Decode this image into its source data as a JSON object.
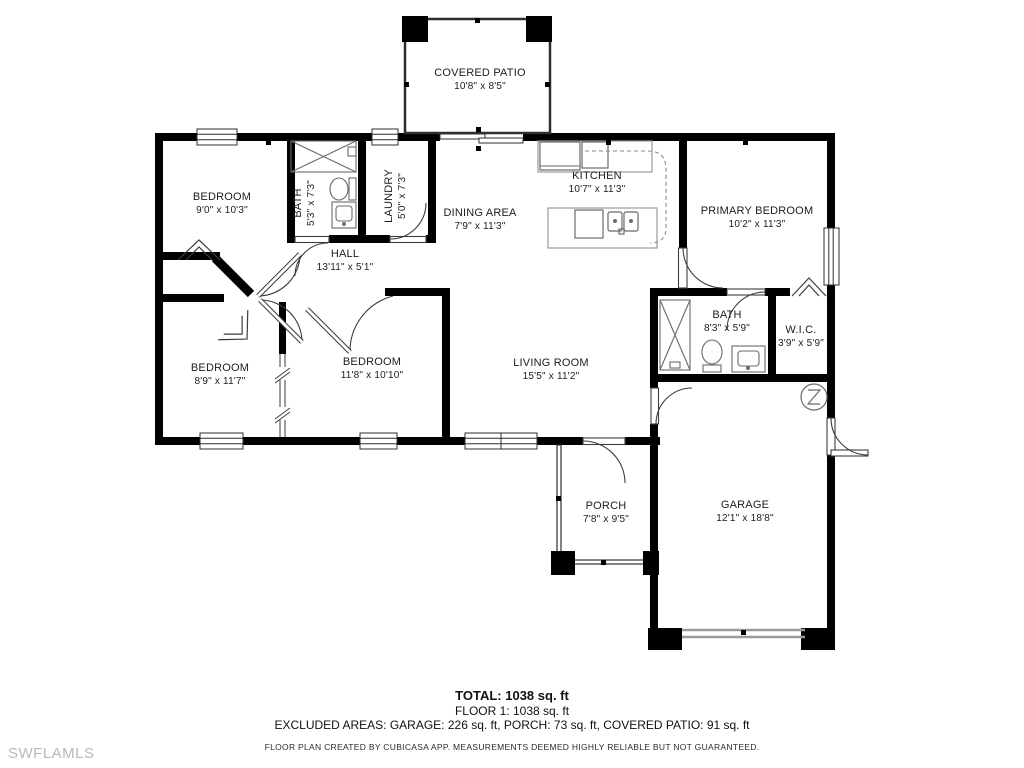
{
  "watermark": "SWFLAMLS",
  "rooms": {
    "covered_patio": {
      "name": "COVERED PATIO",
      "dims": "10'8\" x 8'5\""
    },
    "bedroom1": {
      "name": "BEDROOM",
      "dims": "9'0\" x 10'3\""
    },
    "bath1": {
      "name": "BATH",
      "dims": "5'3\" x 7'3\""
    },
    "laundry": {
      "name": "LAUNDRY",
      "dims": "5'0\" x 7'3\""
    },
    "dining": {
      "name": "DINING AREA",
      "dims": "7'9\" x 11'3\""
    },
    "kitchen": {
      "name": "KITCHEN",
      "dims": "10'7\" x 11'3\""
    },
    "primary": {
      "name": "PRIMARY BEDROOM",
      "dims": "10'2\" x 11'3\""
    },
    "hall": {
      "name": "HALL",
      "dims": "13'11\" x 5'1\""
    },
    "bath2": {
      "name": "BATH",
      "dims": "8'3\" x 5'9\""
    },
    "wic": {
      "name": "W.I.C.",
      "dims": "3'9\" x 5'9\""
    },
    "bedroom2": {
      "name": "BEDROOM",
      "dims": "8'9\" x 11'7\""
    },
    "bedroom3": {
      "name": "BEDROOM",
      "dims": "11'8\" x 10'10\""
    },
    "living": {
      "name": "LIVING ROOM",
      "dims": "15'5\" x 11'2\""
    },
    "porch": {
      "name": "PORCH",
      "dims": "7'8\" x 9'5\""
    },
    "garage": {
      "name": "GARAGE",
      "dims": "12'1\" x 18'8\""
    }
  },
  "summary": {
    "total": "TOTAL: 1038 sq. ft",
    "floor": "FLOOR 1: 1038 sq. ft",
    "excluded": "EXCLUDED AREAS: GARAGE: 226 sq. ft, PORCH: 73 sq. ft, COVERED PATIO: 91 sq. ft",
    "disclaimer": "FLOOR PLAN CREATED BY CUBICASA APP. MEASUREMENTS DEEMED HIGHLY RELIABLE BUT NOT GUARANTEED."
  },
  "colors": {
    "wall": "#000000",
    "thin_line": "#3c3c3c",
    "fixture": "#6a6a6a",
    "counter": "#9a9a9a",
    "text": "#1d1d1d",
    "watermark": "#b9b9b9"
  }
}
